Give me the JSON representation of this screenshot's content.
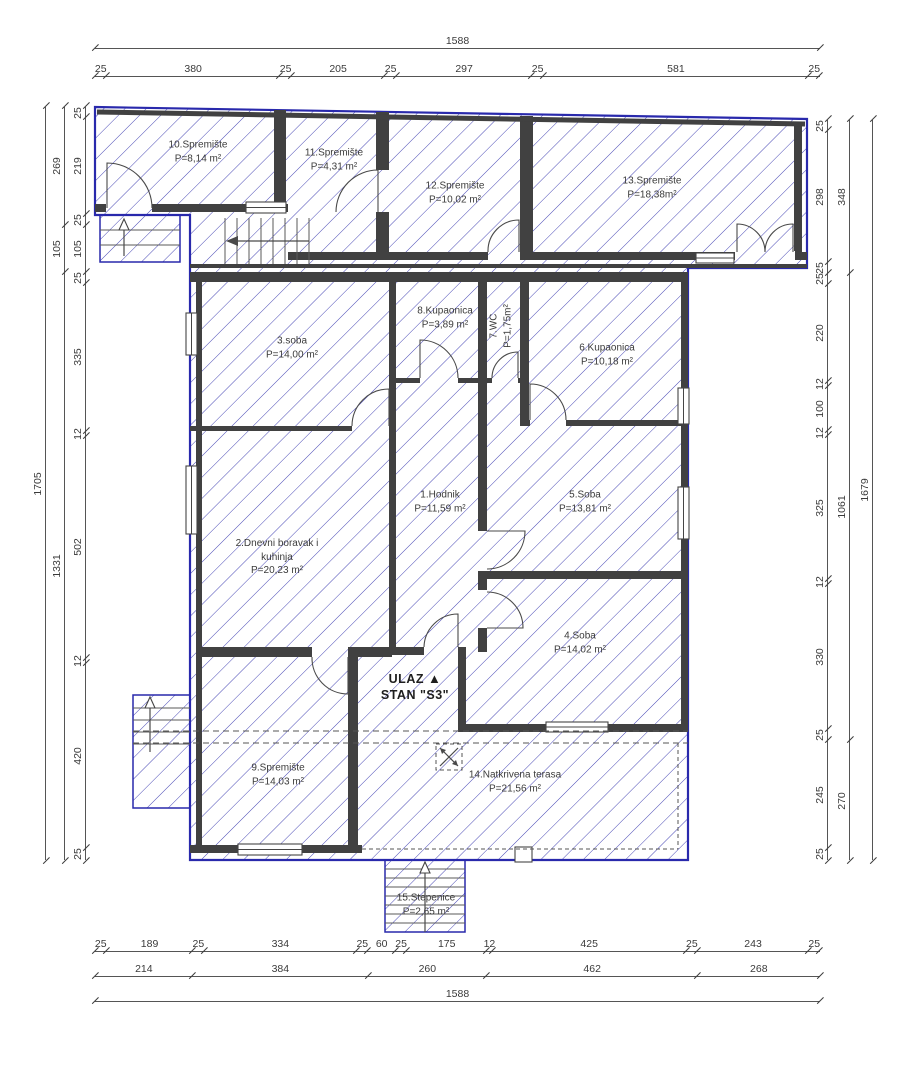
{
  "drawing_type": "floor-plan",
  "entrance": {
    "line1": "ULAZ",
    "marker": "▲",
    "line2": "STAN \"S3\""
  },
  "rooms": {
    "r1": {
      "name": "1.Hodnik",
      "area": "P=11,59 m²"
    },
    "r2": {
      "name1": "2.Dnevni boravak i",
      "name2": "kuhinja",
      "area": "P=20,23 m²"
    },
    "r3": {
      "name": "3.soba",
      "area": "P=14,00 m²"
    },
    "r4": {
      "name": "4.Soba",
      "area": "P=14,02 m²"
    },
    "r5": {
      "name": "5.Soba",
      "area": "P=13,81 m²"
    },
    "r6": {
      "name": "6.Kupaonica",
      "area": "P=10,18 m²"
    },
    "r7": {
      "name": "7.WC",
      "area": "P=1,75m²"
    },
    "r8": {
      "name": "8.Kupaonica",
      "area": "P=3,89 m²"
    },
    "r9": {
      "name": "9.Spremište",
      "area": "P=14,03 m²"
    },
    "r10": {
      "name": "10.Spremište",
      "area": "P=8,14 m²"
    },
    "r11": {
      "name": "11.Spremište",
      "area": "P=4,31 m²"
    },
    "r12": {
      "name": "12.Spremište",
      "area": "P=10,02 m²"
    },
    "r13": {
      "name": "13.Spremište",
      "area": "P=18,38m²"
    },
    "r14": {
      "name": "14.Natkrivena terasa",
      "area": "P=21,56 m²"
    },
    "r15": {
      "name": "15.Stepenice",
      "area": "P=2,65 m²"
    }
  },
  "dimensions": {
    "top_total": {
      "values": [
        1588
      ]
    },
    "top_segments": {
      "values": [
        25,
        380,
        25,
        205,
        25,
        297,
        25,
        581,
        25
      ]
    },
    "bottom_segments": {
      "values": [
        25,
        189,
        25,
        334,
        25,
        60,
        25,
        175,
        12,
        425,
        25,
        243,
        25
      ]
    },
    "bottom_groups": {
      "values": [
        214,
        384,
        260,
        462,
        268
      ]
    },
    "bottom_total": {
      "values": [
        1588
      ]
    },
    "left_outer": {
      "values": [
        1705
      ]
    },
    "left_middle": {
      "values": [
        269,
        105,
        1331
      ]
    },
    "left_inner": {
      "values": [
        25,
        219,
        25,
        105,
        25,
        335,
        12,
        502,
        12,
        420,
        25
      ]
    },
    "right_inner": {
      "values": [
        25,
        298,
        25,
        25,
        220,
        12,
        100,
        12,
        325,
        12,
        330,
        25,
        245,
        25
      ]
    },
    "right_middle": {
      "values": [
        348,
        1061,
        270
      ]
    },
    "right_outer": {
      "values": [
        1679
      ]
    }
  },
  "colors": {
    "outline": "#2929ac",
    "hatch": "#4a4ab6",
    "wall": "#414141",
    "dim_text": "#3a3a3a"
  }
}
